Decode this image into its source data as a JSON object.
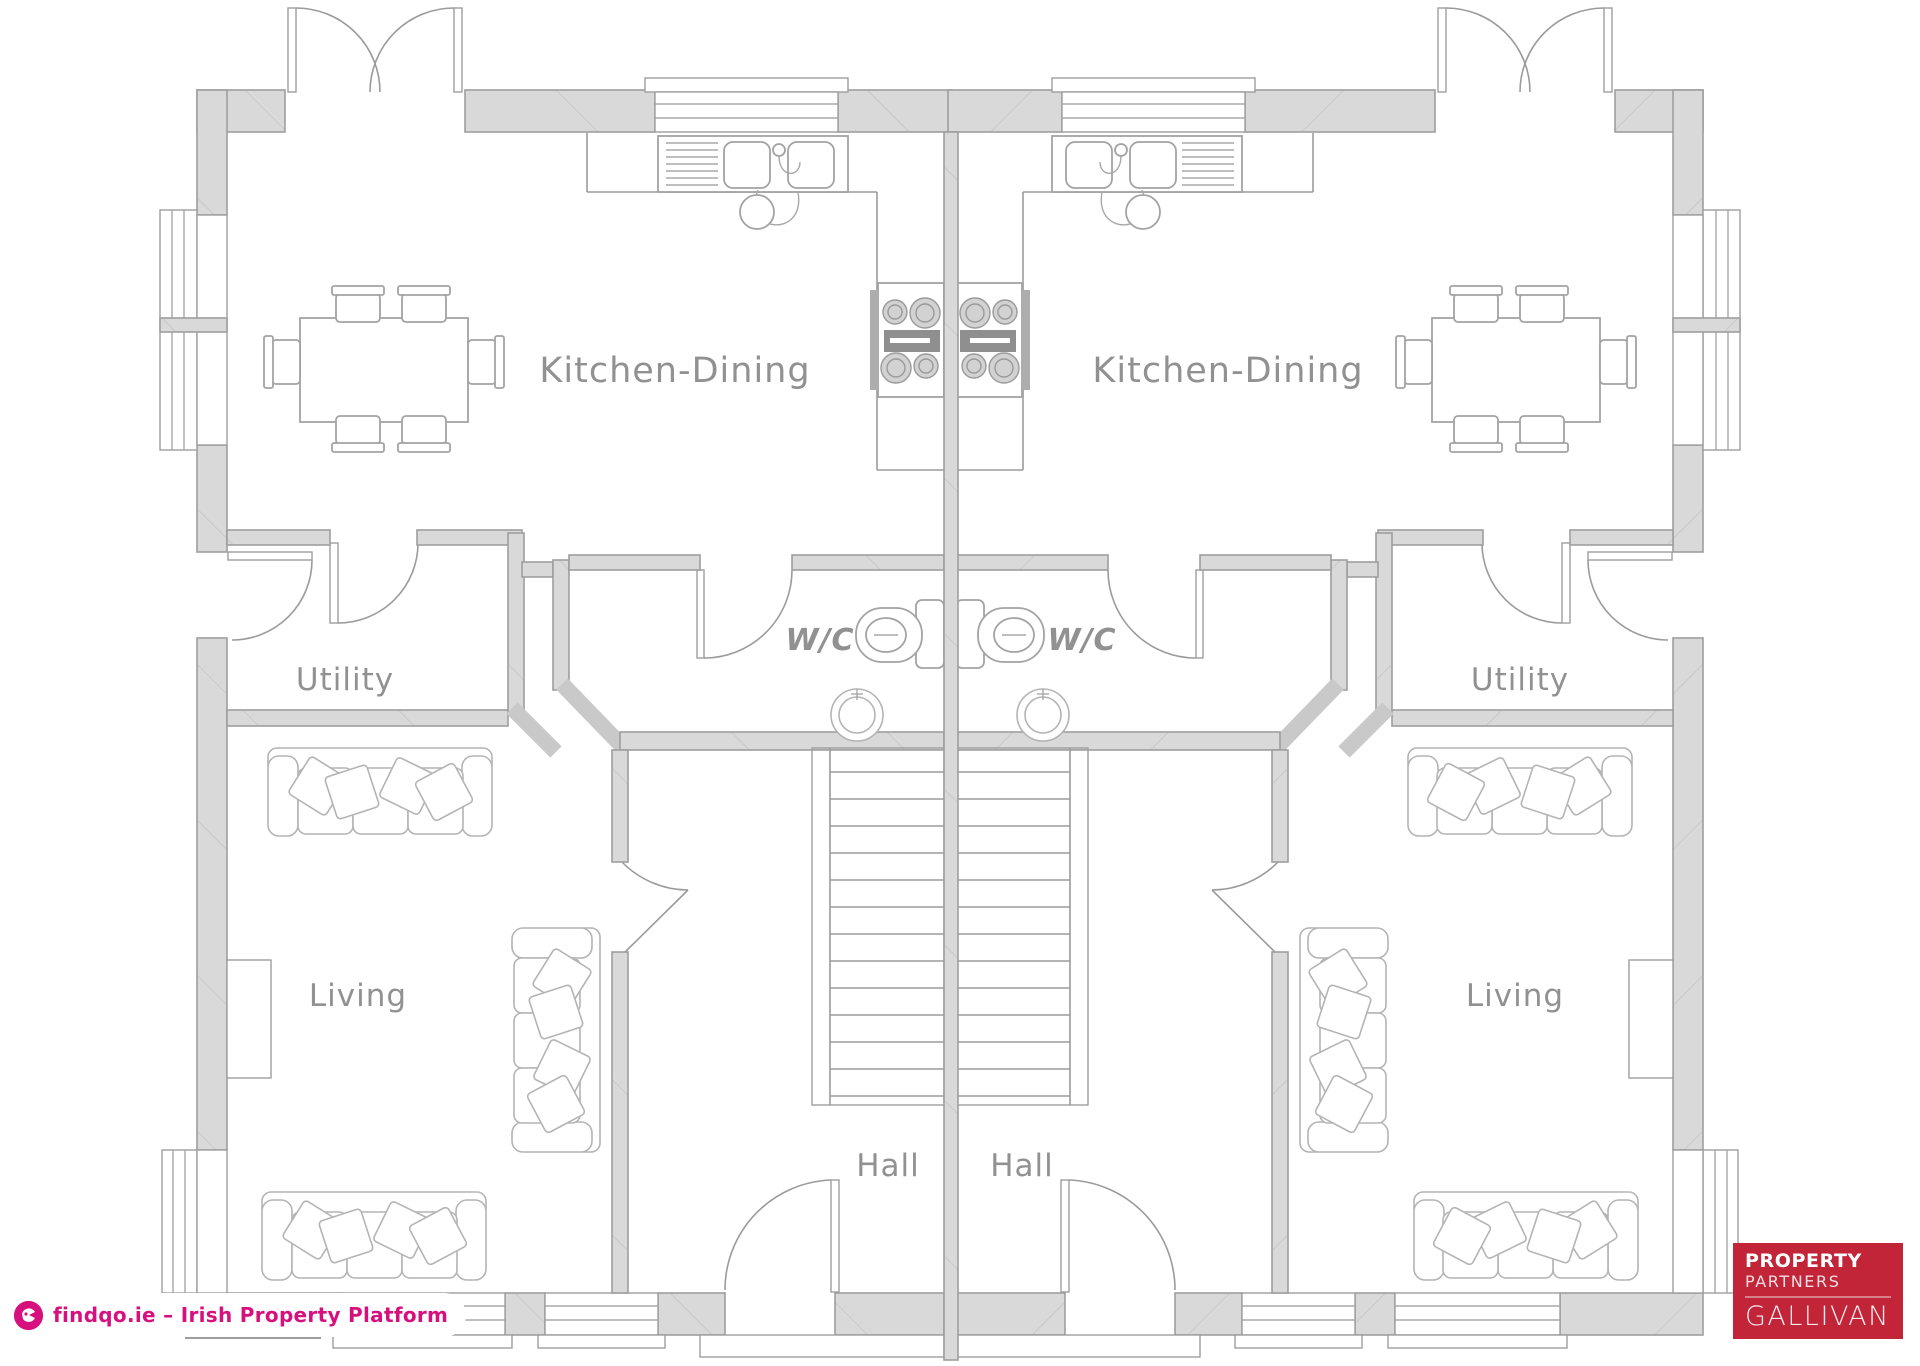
{
  "plan": {
    "rooms": {
      "kitchen_dining_left": "Kitchen-Dining",
      "kitchen_dining_right": "Kitchen-Dining",
      "utility_left": "Utility",
      "utility_right": "Utility",
      "wc_left": "W/C",
      "wc_right": "W/C",
      "living_left": "Living",
      "living_right": "Living",
      "hall_left": "Hall",
      "hall_right": "Hall"
    }
  },
  "watermark": {
    "text": "findqo.ie – Irish Property Platform",
    "icon": "findqo-logo-icon",
    "color": "#d6117e"
  },
  "logo": {
    "line1": "PROPERTY",
    "line2": "PARTNERS",
    "line3": "GALLIVAN",
    "bg_color": "#c22438"
  },
  "colors": {
    "wall_fill": "#d9d9d9",
    "wall_stroke": "#9e9e9e",
    "line": "#9b9b9b",
    "label": "#919191"
  }
}
